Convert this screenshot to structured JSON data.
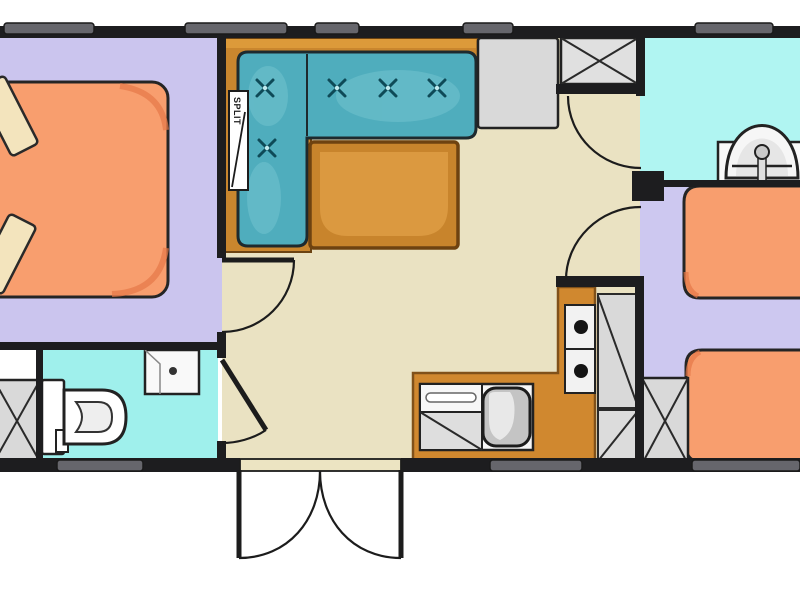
{
  "labels": {
    "split": "SPLIT"
  },
  "colors": {
    "wall": "#1d1d1f",
    "window": "#66666c",
    "threshold": "#ece4c2",
    "floor_bedroom_left": "#cbc5ee",
    "floor_bedroom_right": "#cdc8f0",
    "floor_living": "#eae2c2",
    "floor_bath": "#9ff0ec",
    "floor_shower": "#b0f5f2",
    "sofa": "#4fadbd",
    "sofa_highlight": "#79c8d2",
    "sofa_button": "#0e4a57",
    "platform": "#c9862e",
    "platform_top": "#dc9a3a",
    "table": "#c8842c",
    "table_top": "#db9940",
    "bed": "#f89e6e",
    "bed_shade": "#e57747",
    "pillow": "#f3e4bd",
    "cabinet": "#d9d9d9",
    "kitchen_counter": "#d0882f",
    "fixture_white": "#f9f9f9",
    "basin_gray": "#c4c4c4",
    "door_line": "#1c1c1c"
  },
  "plan": {
    "type": "mobile-home floor plan",
    "rooms": [
      {
        "name": "bedroom-left",
        "furniture": [
          "double-bed",
          "two-pillows"
        ]
      },
      {
        "name": "bathroom",
        "furniture": [
          "toilet",
          "washbasin",
          "wardrobe"
        ]
      },
      {
        "name": "living-room",
        "furniture": [
          "l-shaped-sofa",
          "coffee-table",
          "split-unit",
          "tall-cabinet",
          "crossed-wardrobe"
        ]
      },
      {
        "name": "kitchen",
        "furniture": [
          "sink-with-drainer",
          "two-burner-stove",
          "hatched-cabinets"
        ]
      },
      {
        "name": "shower-room",
        "furniture": [
          "washbasin"
        ]
      },
      {
        "name": "bedroom-right",
        "furniture": [
          "single-bed",
          "single-bed",
          "crossed-wardrobe"
        ]
      }
    ],
    "windows_top_count": 5,
    "windows_bottom_count": 3,
    "entrance": "outward-swinging double door, bottom center"
  }
}
